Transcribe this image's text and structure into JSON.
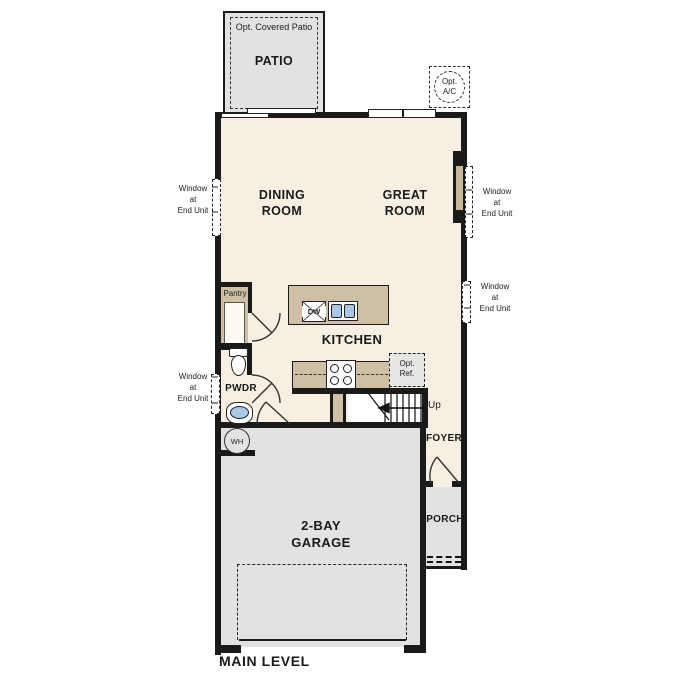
{
  "title": "MAIN LEVEL",
  "patio": {
    "opt_label": "Opt. Covered Patio",
    "label": "PATIO"
  },
  "ac": {
    "label": "Opt.\nA/C"
  },
  "rooms": {
    "dining": "DINING\nROOM",
    "great": "GREAT\nROOM",
    "kitchen": "KITCHEN",
    "pantry": "Pantry",
    "powder": "PWDR",
    "foyer": "FOYER",
    "porch": "PORCH",
    "garage": "2-BAY\nGARAGE"
  },
  "fixtures": {
    "dishwasher": "DW",
    "water_heater": "WH",
    "opt_fridge": "Opt.\nRef.",
    "stairs_up": "Up"
  },
  "windows": {
    "end_unit_label": "Window\nat\nEnd Unit"
  },
  "colors": {
    "wall": "#1a1a1a",
    "interior": "#f7f0e2",
    "cabinet": "#cfc0a5",
    "concrete": "#e2e2e0",
    "optgray": "#e6e6e4",
    "sink": "#a9c7e9",
    "niche": "#c9b99c",
    "line": "#222222"
  }
}
